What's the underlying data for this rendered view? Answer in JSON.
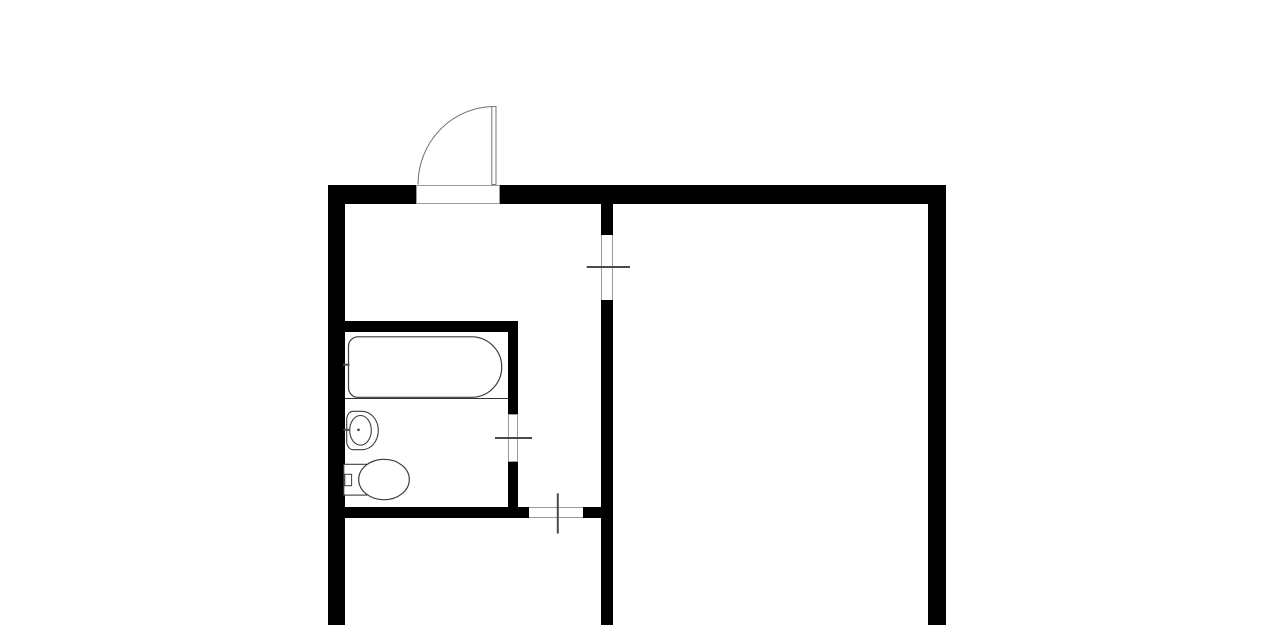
{
  "canvas": {
    "width": 1280,
    "height": 625,
    "background": "#ffffff"
  },
  "colors": {
    "wall": "#000000",
    "background": "#ffffff",
    "door_jamb": "#9b9b9b",
    "door_leaf": "#777777",
    "door_arc": "#6e6e6e",
    "fixture_line": "#3c3c3c",
    "tick_line": "#4a4a4a",
    "thin_partition_line": "#333333"
  },
  "plan": {
    "walls": [
      {
        "name": "top-wall-left-segment",
        "x": 328,
        "y": 184.5,
        "w": 88,
        "h": 19
      },
      {
        "name": "top-wall-right-segment",
        "x": 499.5,
        "y": 184.5,
        "w": 446.5,
        "h": 19
      },
      {
        "name": "left-outer-wall",
        "x": 328,
        "y": 184.5,
        "w": 16.5,
        "h": 440.5
      },
      {
        "name": "right-outer-wall",
        "x": 928,
        "y": 184.5,
        "w": 18,
        "h": 440.5
      },
      {
        "name": "hall-partition-upper",
        "x": 601,
        "y": 203,
        "w": 11.5,
        "h": 31.5
      },
      {
        "name": "hall-partition-lower",
        "x": 601,
        "y": 299.5,
        "w": 11.5,
        "h": 325.5
      },
      {
        "name": "bathroom-top-wall",
        "x": 344.5,
        "y": 321,
        "w": 173.5,
        "h": 10.5
      },
      {
        "name": "bathroom-right-wall-upper",
        "x": 508,
        "y": 331.5,
        "w": 10,
        "h": 82
      },
      {
        "name": "bathroom-right-wall-lower",
        "x": 508,
        "y": 461.5,
        "w": 10,
        "h": 45.5
      },
      {
        "name": "bottom-wall-left-segment",
        "x": 344.5,
        "y": 507.3,
        "w": 184.8,
        "h": 11
      },
      {
        "name": "bottom-wall-right-segment",
        "x": 583.3,
        "y": 507.3,
        "w": 17.7,
        "h": 11
      }
    ],
    "openings": [
      {
        "name": "entry-door-opening",
        "x": 416,
        "y": 184.5,
        "w": 84,
        "h": 19,
        "borders": [
          "top",
          "right",
          "bottom",
          "left"
        ]
      },
      {
        "name": "living-room-door-opening",
        "x": 601,
        "y": 234.5,
        "w": 11.5,
        "h": 65,
        "borders": [
          "left",
          "right"
        ]
      },
      {
        "name": "bathroom-door-opening",
        "x": 508,
        "y": 413.5,
        "w": 10,
        "h": 48,
        "borders": [
          "top",
          "right",
          "bottom",
          "left"
        ]
      },
      {
        "name": "bottom-room-door-opening",
        "x": 529.3,
        "y": 507.3,
        "w": 54,
        "h": 11,
        "borders": [
          "top",
          "bottom"
        ]
      }
    ],
    "shapes": [
      {
        "tag": "path",
        "name": "entry-door-swing-arc",
        "attrs": {
          "d": "M 418 184.5 A 76.5 78 0 0 1 494.3 106.5",
          "stroke": "#6e6e6e",
          "stroke-width": "1",
          "fill": "none"
        }
      },
      {
        "tag": "rect",
        "name": "entry-door-leaf",
        "attrs": {
          "x": "491.8",
          "y": "106.5",
          "width": "4.2",
          "height": "78",
          "stroke": "#777777",
          "stroke-width": "1",
          "fill": "#ffffff"
        }
      },
      {
        "tag": "line",
        "name": "living-room-door-tick",
        "attrs": {
          "x1": "586.7",
          "y1": "267",
          "x2": "630",
          "y2": "267",
          "stroke": "#4a4a4a",
          "stroke-width": "2"
        }
      },
      {
        "tag": "line",
        "name": "bathroom-door-tick",
        "attrs": {
          "x1": "495",
          "y1": "438",
          "x2": "532",
          "y2": "438",
          "stroke": "#4a4a4a",
          "stroke-width": "2"
        }
      },
      {
        "tag": "line",
        "name": "bottom-room-door-tick",
        "attrs": {
          "x1": "557.8",
          "y1": "493.3",
          "x2": "557.8",
          "y2": "533.5",
          "stroke": "#4a4a4a",
          "stroke-width": "2"
        }
      },
      {
        "tag": "line",
        "name": "bathtub-zone-divider-line",
        "attrs": {
          "x1": "344.5",
          "y1": "398.5",
          "x2": "508",
          "y2": "398.5",
          "stroke": "#333333",
          "stroke-width": "1"
        }
      },
      {
        "tag": "path",
        "name": "bathtub",
        "attrs": {
          "d": "M 358 336.8 L 473 336.8 A 30.5 30.3 0 0 1 473 397.3 L 358 397.3 A 9.5 9.5 0 0 1 348.5 387.8 L 348.5 346.3 A 9.5 9.5 0 0 1 358 336.8 Z",
          "stroke": "#3c3c3c",
          "stroke-width": "1.2",
          "fill": "#ffffff"
        }
      },
      {
        "tag": "line",
        "name": "bathtub-faucet-tick",
        "attrs": {
          "x1": "343",
          "y1": "364.7",
          "x2": "349.5",
          "y2": "364.7",
          "stroke": "#4a4a4a",
          "stroke-width": "2"
        }
      },
      {
        "tag": "path",
        "name": "sink-rim",
        "attrs": {
          "d": "M 353 411.3 L 362 411.3 A 16.3 19.2 0 0 1 378.3 430.5 A 16.3 19.2 0 0 1 362 449.7 L 353 449.7 A 6.3 8.5 0 0 1 346.7 441.2 L 346.7 419.8 A 6.3 8.5 0 0 1 353 411.3 Z",
          "stroke": "#3c3c3c",
          "stroke-width": "1.1",
          "fill": "#ffffff"
        }
      },
      {
        "tag": "ellipse",
        "name": "sink-basin",
        "attrs": {
          "cx": "360.5",
          "cy": "430.3",
          "rx": "10.8",
          "ry": "14.8",
          "stroke": "#3c3c3c",
          "stroke-width": "1.1",
          "fill": "none"
        }
      },
      {
        "tag": "circle",
        "name": "sink-drain-dot",
        "attrs": {
          "cx": "358.5",
          "cy": "429.8",
          "r": "1.3",
          "fill": "#3c3c3c"
        }
      },
      {
        "tag": "line",
        "name": "sink-faucet-tick",
        "attrs": {
          "x1": "343.5",
          "y1": "429.8",
          "x2": "350",
          "y2": "429.8",
          "stroke": "#4a4a4a",
          "stroke-width": "2"
        }
      },
      {
        "tag": "rect",
        "name": "toilet-tank",
        "attrs": {
          "x": "343.8",
          "y": "464.3",
          "width": "22.8",
          "height": "30.8",
          "stroke": "#3c3c3c",
          "stroke-width": "1.1",
          "fill": "#ffffff"
        }
      },
      {
        "tag": "rect",
        "name": "toilet-flush-button",
        "attrs": {
          "x": "344.8",
          "y": "474.3",
          "width": "6.8",
          "height": "11.4",
          "stroke": "#3c3c3c",
          "stroke-width": "1",
          "fill": "#ffffff"
        }
      },
      {
        "tag": "ellipse",
        "name": "toilet-bowl",
        "attrs": {
          "cx": "384",
          "cy": "479.5",
          "rx": "25.3",
          "ry": "20.2",
          "stroke": "#3c3c3c",
          "stroke-width": "1.2",
          "fill": "#ffffff"
        }
      }
    ]
  }
}
